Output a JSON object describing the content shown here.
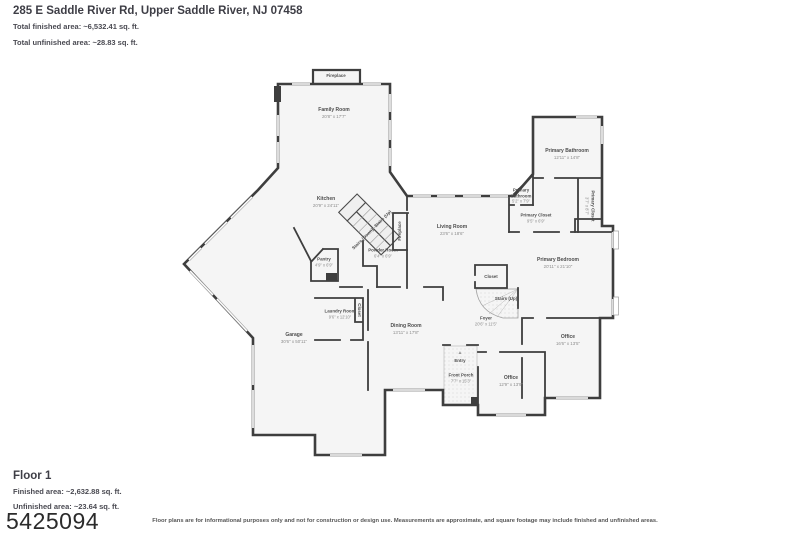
{
  "header": {
    "title": "285 E Saddle River Rd, Upper Saddle River, NJ 07458",
    "total_finished": "Total finished area: ~6,532.41 sq. ft.",
    "total_unfinished": "Total unfinished area: ~28.83 sq. ft."
  },
  "footer": {
    "floor_name": "Floor 1",
    "finished": "Finished area: ~2,632.88 sq. ft.",
    "unfinished": "Unfinished area: ~23.64 sq. ft.",
    "mls_number": "5425094",
    "disclaimer": "Floor plans are for informational purposes only and not for construction or design use. Measurements are approximate, and square footage may include finished and unfinished areas."
  },
  "colors": {
    "wall": "#3e3e3e",
    "floor": "#f5f5f5",
    "window": "#9e9e9e",
    "label": "#4d4d4d",
    "dims": "#8c8c8c"
  },
  "entry_arrow_icon": "▲",
  "rooms": [
    {
      "id": "fireplace-top",
      "name": "Fireplace",
      "dims": "",
      "x": 336,
      "y": 76,
      "rot": 0,
      "small": true
    },
    {
      "id": "family-room",
      "name": "Family Room",
      "dims": "20'8\" x 17'7\"",
      "x": 334,
      "y": 113,
      "rot": 0,
      "small": false
    },
    {
      "id": "kitchen",
      "name": "Kitchen",
      "dims": "20'9\" x 24'11\"",
      "x": 326,
      "y": 202,
      "rot": 0,
      "small": false
    },
    {
      "id": "stairs-up-kitchen",
      "name": "Stairs (Up)",
      "dims": "",
      "x": 383,
      "y": 219,
      "rot": -45,
      "small": true
    },
    {
      "id": "stairs-down-kitchen",
      "name": "Stairs (Down)",
      "dims": "",
      "x": 363,
      "y": 239,
      "rot": -45,
      "small": true
    },
    {
      "id": "fireplace-living",
      "name": "Fireplace",
      "dims": "",
      "x": 400,
      "y": 231,
      "rot": -90,
      "small": true
    },
    {
      "id": "powder-room",
      "name": "Powder Room",
      "dims": "6'4\" x 6'9\"",
      "x": 383,
      "y": 253,
      "rot": 0,
      "small": true
    },
    {
      "id": "pantry",
      "name": "Pantry",
      "dims": "4'9\" x 6'9\"",
      "x": 324,
      "y": 262,
      "rot": 0,
      "small": true
    },
    {
      "id": "living-room",
      "name": "Living Room",
      "dims": "23'6\" x 18'6\"",
      "x": 452,
      "y": 230,
      "rot": 0,
      "small": false
    },
    {
      "id": "primary-bathroom",
      "name": "Primary Bathroom",
      "dims": "12'11\" x 14'8\"",
      "x": 567,
      "y": 154,
      "rot": 0,
      "small": false
    },
    {
      "id": "primary-bathroom-small",
      "name": "Primary Bathroom",
      "dims": "5'2\" x 7'9\"",
      "x": 521,
      "y": 196,
      "rot": 0,
      "small": true,
      "wrap": true
    },
    {
      "id": "primary-closet",
      "name": "Primary Closet",
      "dims": "9'5\" x 6'9\"",
      "x": 536,
      "y": 218,
      "rot": 0,
      "small": true
    },
    {
      "id": "primary-closet-2",
      "name": "Primary Closet",
      "dims": "3'7\" x 8'7\"",
      "x": 590,
      "y": 206,
      "rot": 90,
      "small": true
    },
    {
      "id": "closet-center",
      "name": "Closet",
      "dims": "",
      "x": 491,
      "y": 277,
      "rot": 0,
      "small": true
    },
    {
      "id": "stairs-up-foyer",
      "name": "Stairs (Up)",
      "dims": "",
      "x": 506,
      "y": 299,
      "rot": 0,
      "small": true
    },
    {
      "id": "primary-bedroom",
      "name": "Primary Bedroom",
      "dims": "20'11\" x 21'10\"",
      "x": 558,
      "y": 263,
      "rot": 0,
      "small": false
    },
    {
      "id": "foyer",
      "name": "Foyer",
      "dims": "20'6\" x 11'5\"",
      "x": 486,
      "y": 321,
      "rot": 0,
      "small": true
    },
    {
      "id": "office-right",
      "name": "Office",
      "dims": "16'6\" x 13'5\"",
      "x": 568,
      "y": 340,
      "rot": 0,
      "small": false
    },
    {
      "id": "office-bottom",
      "name": "Office",
      "dims": "12'9\" x 13'9\"",
      "x": 511,
      "y": 381,
      "rot": 0,
      "small": false
    },
    {
      "id": "entry",
      "name": "Entry",
      "dims": "",
      "x": 460,
      "y": 361,
      "rot": 0,
      "small": true
    },
    {
      "id": "front-porch",
      "name": "Front Porch",
      "dims": "7'7\" x 15'3\"",
      "x": 461,
      "y": 378,
      "rot": 0,
      "small": true
    },
    {
      "id": "dining-room",
      "name": "Dining Room",
      "dims": "13'11\" x 17'8\"",
      "x": 406,
      "y": 329,
      "rot": 0,
      "small": false
    },
    {
      "id": "laundry-room",
      "name": "Laundry Room",
      "dims": "9'6\" x 12'10\"",
      "x": 340,
      "y": 314,
      "rot": 0,
      "small": true
    },
    {
      "id": "closet-laundry",
      "name": "Closet",
      "dims": "",
      "x": 359,
      "y": 310,
      "rot": 90,
      "small": true
    },
    {
      "id": "garage",
      "name": "Garage",
      "dims": "30'6\" x 50'11\"",
      "x": 294,
      "y": 338,
      "rot": 0,
      "small": false
    }
  ]
}
